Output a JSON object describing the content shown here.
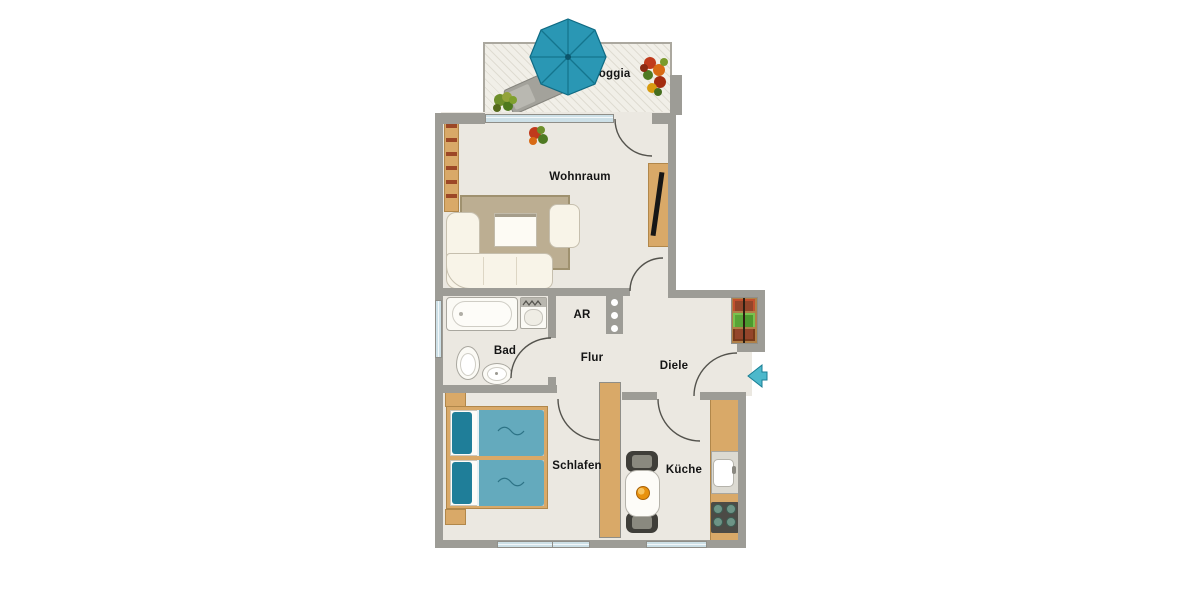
{
  "title": "Apartment floor plan",
  "plan": {
    "labels": {
      "loggia": "Loggia",
      "wohnraum": "Wohnraum",
      "bad": "Bad",
      "ar": "AR",
      "flur": "Flur",
      "diele": "Diele",
      "schlafen": "Schlafen",
      "kueche": "Küche"
    },
    "colors": {
      "wall": "#9d9c96",
      "floor": "#ebe8e1",
      "wood": "#d9a968",
      "teal_umbrella": "#2a97b4",
      "teal_bed_pillow": "#1f7e99",
      "teal_bed_blanket": "#64aabd",
      "window_glass": "#cde0e7",
      "entrance_arrow": "#4cb8cb",
      "rug": "#bcae92"
    },
    "furniture": [
      "parasol",
      "sun-lounger",
      "plants",
      "corner-sofa",
      "armchair",
      "coffee-table",
      "rug",
      "bookshelf",
      "tv-board",
      "bathtub",
      "washing-machine",
      "toilet",
      "wash-basin",
      "coat-hooks",
      "plant-shelf",
      "double-bed",
      "nightstands",
      "wardrobe",
      "dining-table",
      "chairs",
      "fruit-bowl",
      "kitchen-counter",
      "kitchen-sink",
      "stove",
      "entrance-arrow"
    ]
  }
}
